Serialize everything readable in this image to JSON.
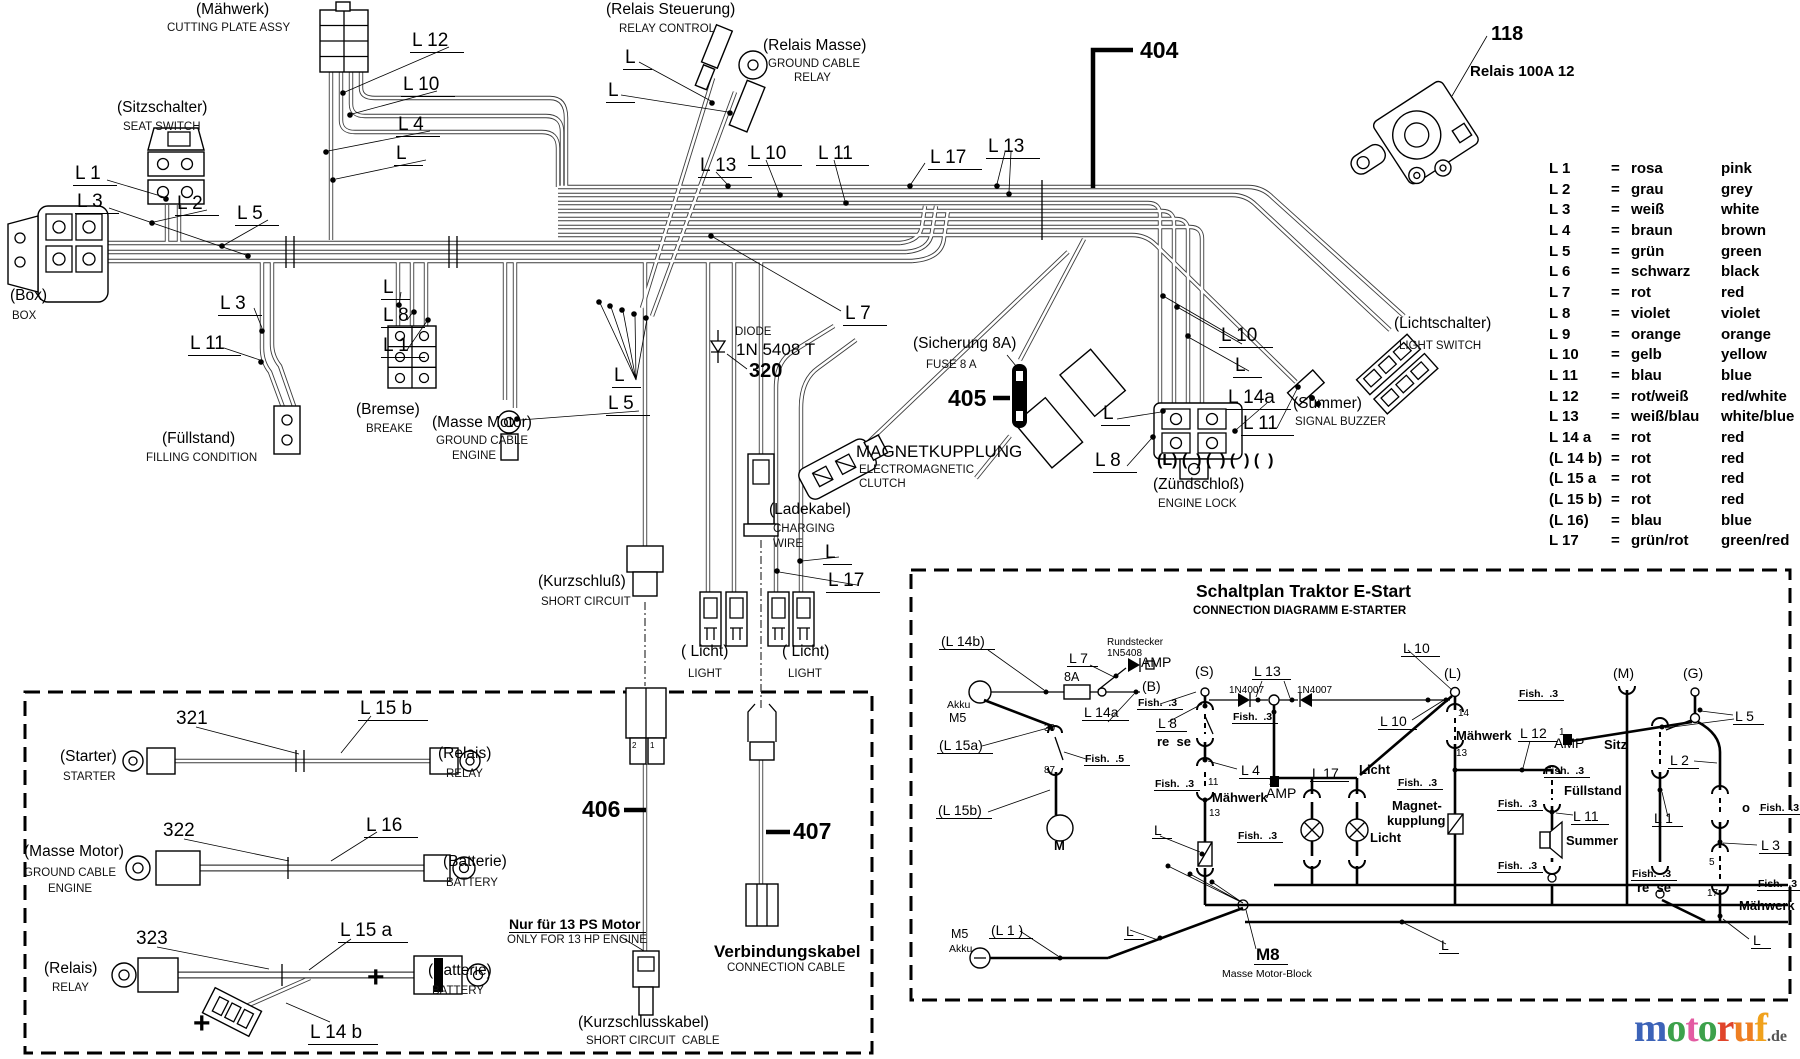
{
  "legend": {
    "eq": "=",
    "rows": [
      {
        "code": "L 1",
        "de": "rosa",
        "en": "pink"
      },
      {
        "code": "L 2",
        "de": "grau",
        "en": "grey"
      },
      {
        "code": "L 3",
        "de": "weiß",
        "en": "white"
      },
      {
        "code": "L 4",
        "de": "braun",
        "en": "brown"
      },
      {
        "code": "L 5",
        "de": "grün",
        "en": "green"
      },
      {
        "code": "L 6",
        "de": "schwarz",
        "en": "black"
      },
      {
        "code": "L 7",
        "de": "rot",
        "en": "red"
      },
      {
        "code": "L 8",
        "de": "violet",
        "en": "violet"
      },
      {
        "code": "L 9",
        "de": "orange",
        "en": "orange"
      },
      {
        "code": "L 10",
        "de": "gelb",
        "en": "yellow"
      },
      {
        "code": "L 11",
        "de": "blau",
        "en": "blue"
      },
      {
        "code": "L 12",
        "de": "rot/weiß",
        "en": "red/white"
      },
      {
        "code": "L 13",
        "de": "weiß/blau",
        "en": "white/blue"
      },
      {
        "code": "L 14 a",
        "de": "rot",
        "en": "red"
      },
      {
        "code": "(L 14 b)",
        "de": "rot",
        "en": "red"
      },
      {
        "code": "(L 15 a",
        "de": "rot",
        "en": "red"
      },
      {
        "code": "(L 15 b)",
        "de": "rot",
        "en": "red"
      },
      {
        "code": "(L 16)",
        "de": "blau",
        "en": "blue"
      },
      {
        "code": "L 17",
        "de": "grün/rot",
        "en": "green/red"
      }
    ]
  },
  "labels": [
    {
      "t": "(Mähwerk)",
      "x": 196,
      "y": 2,
      "c": "de"
    },
    {
      "t": "CUTTING PLATE ASSY",
      "x": 167,
      "y": 22,
      "c": "en"
    },
    {
      "t": "(Sitzschalter)",
      "x": 117,
      "y": 100,
      "c": "de"
    },
    {
      "t": "SEAT SWITCH",
      "x": 123,
      "y": 121,
      "c": "en"
    },
    {
      "t": "(Box)",
      "x": 10,
      "y": 288,
      "c": "de"
    },
    {
      "t": "BOX",
      "x": 12,
      "y": 310,
      "c": "en"
    },
    {
      "t": "(Bremse)",
      "x": 356,
      "y": 402,
      "c": "de"
    },
    {
      "t": "BREAKE",
      "x": 366,
      "y": 423,
      "c": "en"
    },
    {
      "t": "(Masse Motor)",
      "x": 432,
      "y": 415,
      "c": "de"
    },
    {
      "t": "GROUND CABLE",
      "x": 436,
      "y": 435,
      "c": "en"
    },
    {
      "t": "ENGINE",
      "x": 452,
      "y": 450,
      "c": "en"
    },
    {
      "t": "(Füllstand)",
      "x": 162,
      "y": 431,
      "c": "de"
    },
    {
      "t": "FILLING CONDITION",
      "x": 146,
      "y": 452,
      "c": "en"
    },
    {
      "t": "(Kurzschluß)",
      "x": 538,
      "y": 574,
      "c": "de"
    },
    {
      "t": "SHORT CIRCUIT",
      "x": 541,
      "y": 596,
      "c": "en"
    },
    {
      "t": "(Relais Steuerung)",
      "x": 606,
      "y": 2,
      "c": "de"
    },
    {
      "t": "RELAY CONTROL",
      "x": 619,
      "y": 23,
      "c": "en"
    },
    {
      "t": "(Relais Masse)",
      "x": 763,
      "y": 38,
      "c": "de"
    },
    {
      "t": "GROUND CABLE",
      "x": 768,
      "y": 58,
      "c": "en"
    },
    {
      "t": "RELAY",
      "x": 794,
      "y": 72,
      "c": "en"
    },
    {
      "t": "( Licht)",
      "x": 681,
      "y": 644,
      "c": "de"
    },
    {
      "t": "LIGHT",
      "x": 688,
      "y": 668,
      "c": "en"
    },
    {
      "t": "( Licht)",
      "x": 782,
      "y": 644,
      "c": "de"
    },
    {
      "t": "LIGHT",
      "x": 788,
      "y": 668,
      "c": "en"
    },
    {
      "t": "(Ladekabel)",
      "x": 769,
      "y": 502,
      "c": "de"
    },
    {
      "t": "CHARGING",
      "x": 773,
      "y": 523,
      "c": "en"
    },
    {
      "t": "WIRE",
      "x": 773,
      "y": 538,
      "c": "en"
    },
    {
      "t": "MAGNETKUPPLUNG",
      "x": 856,
      "y": 443,
      "c": "t17"
    },
    {
      "t": "ELECTROMAGNETIC",
      "x": 859,
      "y": 464,
      "c": "en"
    },
    {
      "t": "CLUTCH",
      "x": 859,
      "y": 478,
      "c": "en"
    },
    {
      "t": "(Sicherung 8A)",
      "x": 913,
      "y": 336,
      "c": "de"
    },
    {
      "t": "FUSE 8 A",
      "x": 926,
      "y": 359,
      "c": "en"
    },
    {
      "t": "(Zündschloß)",
      "x": 1153,
      "y": 477,
      "c": "de"
    },
    {
      "t": "ENGINE LOCK",
      "x": 1158,
      "y": 498,
      "c": "en"
    },
    {
      "t": "(L) (  ) (  ) (  ) (  )",
      "x": 1157,
      "y": 453,
      "c": "b16"
    },
    {
      "t": "(Summer)",
      "x": 1293,
      "y": 396,
      "c": "de"
    },
    {
      "t": "SIGNAL BUZZER",
      "x": 1295,
      "y": 416,
      "c": "en"
    },
    {
      "t": "(Lichtschalter)",
      "x": 1394,
      "y": 316,
      "c": "de"
    },
    {
      "t": "LIGHT SWITCH",
      "x": 1399,
      "y": 340,
      "c": "en"
    },
    {
      "t": "DIODE",
      "x": 735,
      "y": 326,
      "c": "en"
    },
    {
      "t": "1N 5408 T",
      "x": 736,
      "y": 341,
      "c": "t17"
    },
    {
      "t": "320",
      "x": 749,
      "y": 361,
      "c": "pn"
    },
    {
      "t": "118",
      "x": 1491,
      "y": 24,
      "c": "pn"
    },
    {
      "t": "Relais 100A 12",
      "x": 1470,
      "y": 64,
      "c": "b15"
    },
    {
      "t": "404",
      "x": 1140,
      "y": 38,
      "c": "pn26"
    },
    {
      "t": "405",
      "x": 948,
      "y": 386,
      "c": "pn26"
    },
    {
      "t": "406",
      "x": 582,
      "y": 797,
      "c": "pn26"
    },
    {
      "t": "407",
      "x": 793,
      "y": 819,
      "c": "pn26"
    },
    {
      "t": "Nur für 13 PS Motor",
      "x": 509,
      "y": 917,
      "c": "b14u"
    },
    {
      "t": "ONLY FOR 13 HP ENGINE",
      "x": 507,
      "y": 934,
      "c": "en"
    },
    {
      "t": "Verbindungskabel",
      "x": 714,
      "y": 943,
      "c": "b17"
    },
    {
      "t": "CONNECTION CABLE",
      "x": 727,
      "y": 962,
      "c": "en"
    },
    {
      "t": "(Kurzschlusskabel)",
      "x": 578,
      "y": 1015,
      "c": "de"
    },
    {
      "t": "SHORT CIRCUIT  CABLE",
      "x": 586,
      "y": 1035,
      "c": "en"
    },
    {
      "t": "321",
      "x": 176,
      "y": 709,
      "c": "cn"
    },
    {
      "t": "322",
      "x": 163,
      "y": 821,
      "c": "cn"
    },
    {
      "t": "323",
      "x": 136,
      "y": 929,
      "c": "cn"
    },
    {
      "t": "L 15 b",
      "x": 358,
      "y": 699,
      "c": "wl"
    },
    {
      "t": "L 16",
      "x": 364,
      "y": 816,
      "c": "wl"
    },
    {
      "t": "L 15 a",
      "x": 338,
      "y": 921,
      "c": "wl"
    },
    {
      "t": "L 14 b",
      "x": 308,
      "y": 1023,
      "c": "wl"
    },
    {
      "t": "(Starter)",
      "x": 60,
      "y": 749,
      "c": "de"
    },
    {
      "t": "STARTER",
      "x": 63,
      "y": 771,
      "c": "en"
    },
    {
      "t": "(Relais)",
      "x": 438,
      "y": 746,
      "c": "de"
    },
    {
      "t": "RELAY",
      "x": 446,
      "y": 768,
      "c": "en"
    },
    {
      "t": "(Masse Motor)",
      "x": 24,
      "y": 844,
      "c": "de"
    },
    {
      "t": "GROUND CABLE",
      "x": 24,
      "y": 867,
      "c": "en"
    },
    {
      "t": "ENGINE",
      "x": 48,
      "y": 883,
      "c": "en"
    },
    {
      "t": "(Batterie)",
      "x": 443,
      "y": 854,
      "c": "de"
    },
    {
      "t": "BATTERY",
      "x": 446,
      "y": 877,
      "c": "en"
    },
    {
      "t": "(Relais)",
      "x": 44,
      "y": 961,
      "c": "de"
    },
    {
      "t": "RELAY",
      "x": 52,
      "y": 982,
      "c": "en"
    },
    {
      "t": "(Batterie)",
      "x": 428,
      "y": 963,
      "c": "de"
    },
    {
      "t": "BATTERY",
      "x": 432,
      "y": 985,
      "c": "en"
    },
    {
      "t": "+",
      "x": 193,
      "y": 1008,
      "c": "plus"
    },
    {
      "t": "+",
      "x": 367,
      "y": 962,
      "c": "plus"
    },
    {
      "t": "2",
      "x": 632,
      "y": 742,
      "c": "tiny"
    },
    {
      "t": "1",
      "x": 650,
      "y": 742,
      "c": "tiny"
    },
    {
      "t": "L 12",
      "x": 410,
      "y": 31,
      "c": "wl"
    },
    {
      "t": "L 10",
      "x": 401,
      "y": 75,
      "c": "wl"
    },
    {
      "t": "L 4",
      "x": 396,
      "y": 115,
      "c": "wl"
    },
    {
      "t": "L",
      "x": 394,
      "y": 144,
      "c": "wl"
    },
    {
      "t": "L 1",
      "x": 73,
      "y": 164,
      "c": "wl"
    },
    {
      "t": "L 3",
      "x": 75,
      "y": 192,
      "c": "wl"
    },
    {
      "t": "L 2",
      "x": 175,
      "y": 194,
      "c": "wl"
    },
    {
      "t": "L 5",
      "x": 235,
      "y": 204,
      "c": "wl"
    },
    {
      "t": "L",
      "x": 381,
      "y": 278,
      "c": "wl"
    },
    {
      "t": "L 3",
      "x": 218,
      "y": 294,
      "c": "wl"
    },
    {
      "t": "L 8",
      "x": 381,
      "y": 306,
      "c": "wl"
    },
    {
      "t": "L 11",
      "x": 188,
      "y": 334,
      "c": "wl"
    },
    {
      "t": "L 1",
      "x": 381,
      "y": 336,
      "c": "wl"
    },
    {
      "t": "L",
      "x": 623,
      "y": 48,
      "c": "wl"
    },
    {
      "t": "L",
      "x": 606,
      "y": 81,
      "c": "wl"
    },
    {
      "t": "L 13",
      "x": 698,
      "y": 156,
      "c": "wl"
    },
    {
      "t": "L 10",
      "x": 748,
      "y": 144,
      "c": "wl"
    },
    {
      "t": "L 11",
      "x": 816,
      "y": 144,
      "c": "wl"
    },
    {
      "t": "L 17",
      "x": 928,
      "y": 148,
      "c": "wl"
    },
    {
      "t": "L 13",
      "x": 986,
      "y": 137,
      "c": "wl"
    },
    {
      "t": "L 7",
      "x": 843,
      "y": 304,
      "c": "wl"
    },
    {
      "t": "L",
      "x": 612,
      "y": 366,
      "c": "wl"
    },
    {
      "t": "L 5",
      "x": 606,
      "y": 394,
      "c": "wl"
    },
    {
      "t": "L",
      "x": 823,
      "y": 543,
      "c": "wl"
    },
    {
      "t": "L 17",
      "x": 826,
      "y": 571,
      "c": "wl"
    },
    {
      "t": "L 10",
      "x": 1219,
      "y": 326,
      "c": "wl"
    },
    {
      "t": "L",
      "x": 1233,
      "y": 356,
      "c": "wl"
    },
    {
      "t": "L 14a",
      "x": 1226,
      "y": 388,
      "c": "wl"
    },
    {
      "t": "L 11",
      "x": 1241,
      "y": 414,
      "c": "wl"
    },
    {
      "t": "L",
      "x": 1101,
      "y": 404,
      "c": "wl"
    },
    {
      "t": "L 8",
      "x": 1093,
      "y": 451,
      "c": "wl"
    }
  ],
  "schaltplan": {
    "labels": [
      {
        "t": "Schaltplan Traktor E-Start",
        "x": 1196,
        "y": 582,
        "c": "title"
      },
      {
        "t": "CONNECTION DIAGRAMM E-STARTER",
        "x": 1193,
        "y": 605,
        "c": "subtitle"
      },
      {
        "t": "(L 14b)",
        "x": 939,
        "y": 634,
        "c": "s15u"
      },
      {
        "t": "L 7",
        "x": 1067,
        "y": 651,
        "c": "s15u"
      },
      {
        "t": "Rundstecker",
        "x": 1107,
        "y": 638,
        "c": "s10"
      },
      {
        "t": "1N5408",
        "x": 1107,
        "y": 649,
        "c": "s10"
      },
      {
        "t": "AMP",
        "x": 1141,
        "y": 655,
        "c": "s15"
      },
      {
        "t": "8A",
        "x": 1064,
        "y": 671,
        "c": "s13"
      },
      {
        "t": "(B)",
        "x": 1142,
        "y": 679,
        "c": "s15"
      },
      {
        "t": "(S)",
        "x": 1195,
        "y": 664,
        "c": "s15"
      },
      {
        "t": "L 13",
        "x": 1252,
        "y": 664,
        "c": "s15u"
      },
      {
        "t": "1N4007",
        "x": 1229,
        "y": 686,
        "c": "s10"
      },
      {
        "t": "1N4007",
        "x": 1297,
        "y": 686,
        "c": "s10"
      },
      {
        "t": "Akku",
        "x": 947,
        "y": 700,
        "c": "s11"
      },
      {
        "t": "M5",
        "x": 949,
        "y": 712,
        "c": "s13"
      },
      {
        "t": "Fish.  .3",
        "x": 1137,
        "y": 698,
        "c": "s10b"
      },
      {
        "t": "L 14a",
        "x": 1082,
        "y": 705,
        "c": "s15u"
      },
      {
        "t": "L 8",
        "x": 1156,
        "y": 716,
        "c": "s15u"
      },
      {
        "t": "Fish.  .3",
        "x": 1232,
        "y": 712,
        "c": "s10b"
      },
      {
        "t": "re  se",
        "x": 1157,
        "y": 735,
        "c": "s13b"
      },
      {
        "t": "(L 15a)",
        "x": 937,
        "y": 738,
        "c": "s15u"
      },
      {
        "t": "30",
        "x": 1044,
        "y": 724,
        "c": "s10"
      },
      {
        "t": "87",
        "x": 1044,
        "y": 766,
        "c": "s10"
      },
      {
        "t": "Fish.  .5",
        "x": 1084,
        "y": 754,
        "c": "s10b"
      },
      {
        "t": "L 4",
        "x": 1239,
        "y": 763,
        "c": "s15u"
      },
      {
        "t": "11",
        "x": 1208,
        "y": 778,
        "c": "s10"
      },
      {
        "t": "Fish.  .3",
        "x": 1154,
        "y": 779,
        "c": "s10b"
      },
      {
        "t": "Mähwerk",
        "x": 1212,
        "y": 791,
        "c": "s13b"
      },
      {
        "t": "13",
        "x": 1209,
        "y": 809,
        "c": "s10"
      },
      {
        "t": "2",
        "x": 1269,
        "y": 778,
        "c": "s10"
      },
      {
        "t": "AMP",
        "x": 1266,
        "y": 786,
        "c": "s15"
      },
      {
        "t": "L 17",
        "x": 1310,
        "y": 766,
        "c": "s15u"
      },
      {
        "t": "Licht",
        "x": 1359,
        "y": 763,
        "c": "s13b"
      },
      {
        "t": "L 10",
        "x": 1401,
        "y": 641,
        "c": "s15u"
      },
      {
        "t": "L 10",
        "x": 1378,
        "y": 714,
        "c": "s15u"
      },
      {
        "t": "(L)",
        "x": 1444,
        "y": 666,
        "c": "s15"
      },
      {
        "t": "(M)",
        "x": 1613,
        "y": 666,
        "c": "s15"
      },
      {
        "t": "(G)",
        "x": 1683,
        "y": 666,
        "c": "s15"
      },
      {
        "t": "Fish.  .3",
        "x": 1518,
        "y": 689,
        "c": "s10b"
      },
      {
        "t": "14",
        "x": 1458,
        "y": 709,
        "c": "s10"
      },
      {
        "t": "Mähwerk",
        "x": 1456,
        "y": 729,
        "c": "s13b"
      },
      {
        "t": "L 12",
        "x": 1518,
        "y": 726,
        "c": "s15u"
      },
      {
        "t": "13",
        "x": 1456,
        "y": 749,
        "c": "s10"
      },
      {
        "t": "L 5",
        "x": 1733,
        "y": 709,
        "c": "s15u"
      },
      {
        "t": "1",
        "x": 1559,
        "y": 728,
        "c": "s10"
      },
      {
        "t": "AMP",
        "x": 1554,
        "y": 736,
        "c": "s15"
      },
      {
        "t": "Sitz",
        "x": 1604,
        "y": 738,
        "c": "s13b"
      },
      {
        "t": "L 2",
        "x": 1668,
        "y": 753,
        "c": "s15u"
      },
      {
        "t": "Fish.  .3",
        "x": 1544,
        "y": 766,
        "c": "s10b"
      },
      {
        "t": "L",
        "x": 1152,
        "y": 823,
        "c": "s15u"
      },
      {
        "t": "Fish.  .3",
        "x": 1237,
        "y": 831,
        "c": "s10b"
      },
      {
        "t": "(L 15b)",
        "x": 936,
        "y": 803,
        "c": "s15u"
      },
      {
        "t": "M",
        "x": 1054,
        "y": 839,
        "c": "s13b"
      },
      {
        "t": "Magnet-",
        "x": 1392,
        "y": 799,
        "c": "s13b"
      },
      {
        "t": "kupplung",
        "x": 1387,
        "y": 814,
        "c": "s13b"
      },
      {
        "t": "Licht",
        "x": 1370,
        "y": 831,
        "c": "s13b"
      },
      {
        "t": "Fish.  .3",
        "x": 1397,
        "y": 778,
        "c": "s10b"
      },
      {
        "t": "Fish.  .3",
        "x": 1497,
        "y": 799,
        "c": "s10b"
      },
      {
        "t": "Füllstand",
        "x": 1564,
        "y": 784,
        "c": "s13b"
      },
      {
        "t": "L 11",
        "x": 1571,
        "y": 809,
        "c": "s15u"
      },
      {
        "t": "Summer",
        "x": 1566,
        "y": 834,
        "c": "s13b"
      },
      {
        "t": "Fish.  .3",
        "x": 1497,
        "y": 861,
        "c": "s10b"
      },
      {
        "t": "L 1",
        "x": 1652,
        "y": 811,
        "c": "s15u"
      },
      {
        "t": "Fish.  .3",
        "x": 1631,
        "y": 869,
        "c": "s10b"
      },
      {
        "t": "re  se",
        "x": 1637,
        "y": 881,
        "c": "s13b"
      },
      {
        "t": "o",
        "x": 1742,
        "y": 801,
        "c": "s13b"
      },
      {
        "t": "Fish.  .3",
        "x": 1759,
        "y": 803,
        "c": "s10b"
      },
      {
        "t": "L 3",
        "x": 1759,
        "y": 838,
        "c": "s15u"
      },
      {
        "t": "5",
        "x": 1709,
        "y": 858,
        "c": "s10"
      },
      {
        "t": "17",
        "x": 1707,
        "y": 889,
        "c": "s10"
      },
      {
        "t": "Fish.  .3",
        "x": 1757,
        "y": 879,
        "c": "s10b"
      },
      {
        "t": "Mähwerk",
        "x": 1739,
        "y": 899,
        "c": "s13b"
      },
      {
        "t": "L",
        "x": 1751,
        "y": 933,
        "c": "s15u"
      },
      {
        "t": "L",
        "x": 1439,
        "y": 938,
        "c": "s15u"
      },
      {
        "t": "M5",
        "x": 951,
        "y": 928,
        "c": "s13"
      },
      {
        "t": "Akku",
        "x": 949,
        "y": 944,
        "c": "s11"
      },
      {
        "t": "(L 1 )",
        "x": 989,
        "y": 923,
        "c": "s15u"
      },
      {
        "t": "L",
        "x": 1124,
        "y": 924,
        "c": "s15u"
      },
      {
        "t": "M8",
        "x": 1254,
        "y": 946,
        "c": "b17u"
      },
      {
        "t": "Masse Motor-Block",
        "x": 1222,
        "y": 969,
        "c": "s11"
      }
    ]
  },
  "logo": {
    "letters": [
      {
        "t": "m",
        "color": "#3c63b8"
      },
      {
        "t": "o",
        "color": "#3da14b"
      },
      {
        "t": "t",
        "color": "#e35ba2"
      },
      {
        "t": "o",
        "color": "#3da14b"
      },
      {
        "t": "r",
        "color": "#e0442b"
      },
      {
        "t": "u",
        "color": "#ee7e22"
      },
      {
        "t": "f",
        "color": "#f0a11c"
      }
    ],
    "suffix": ".de"
  }
}
